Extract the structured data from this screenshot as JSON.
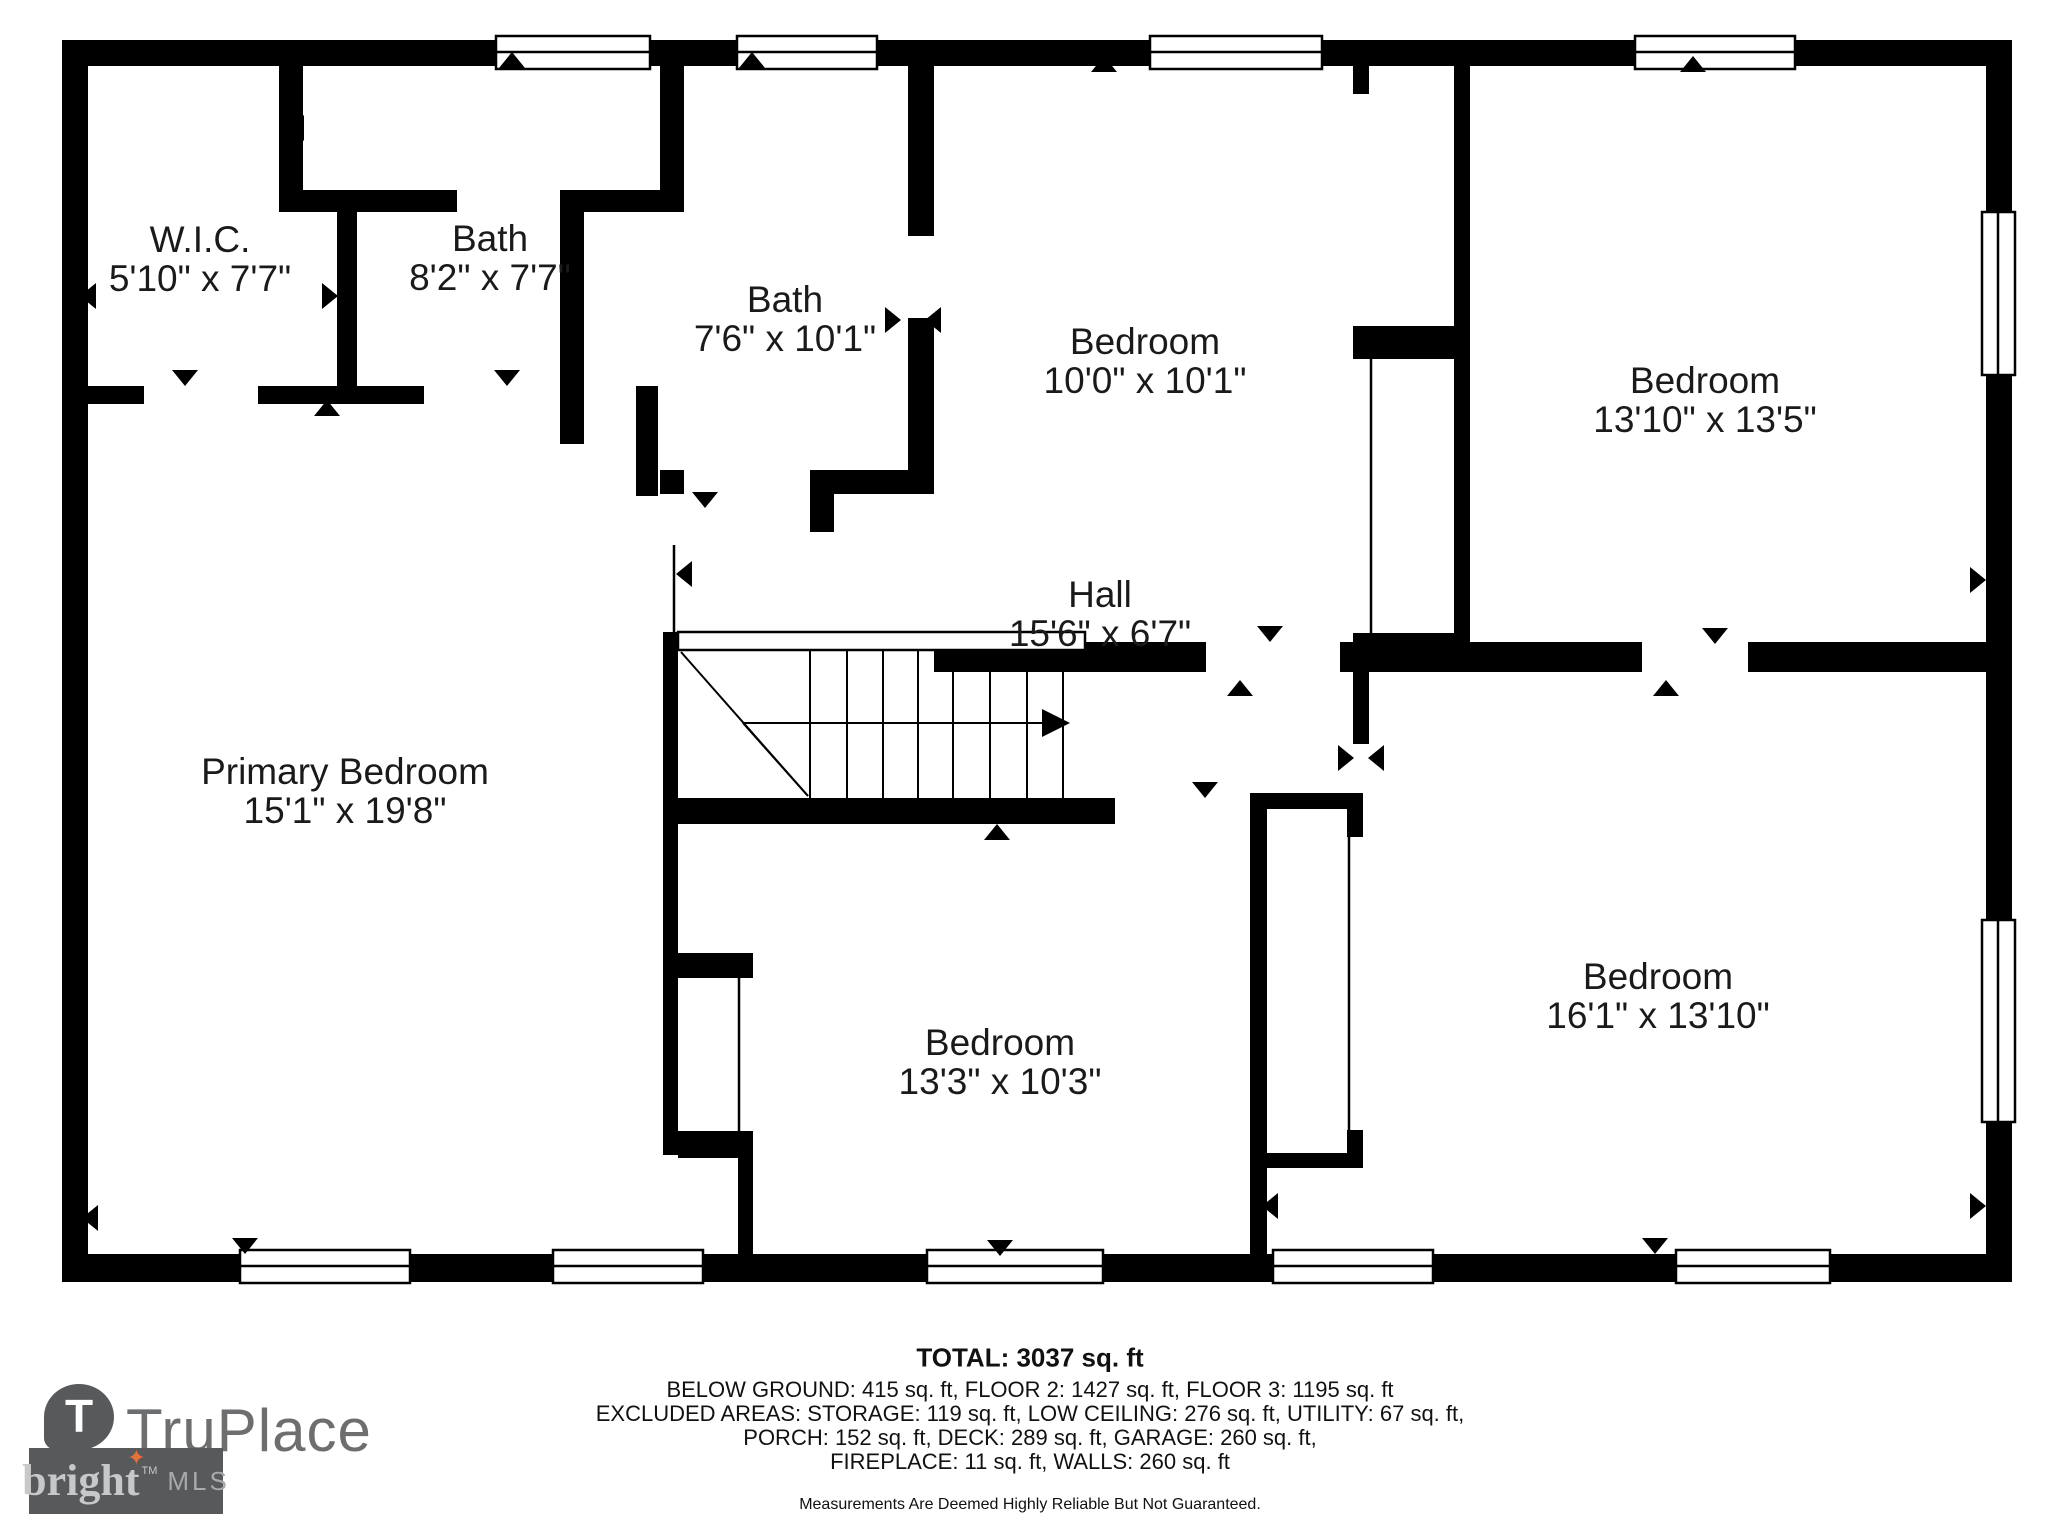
{
  "rooms": [
    {
      "name": "W.I.C.",
      "dims": "5'10\" x 7'7\""
    },
    {
      "name": "Bath",
      "dims": "8'2\" x 7'7\""
    },
    {
      "name": "Bath",
      "dims": "7'6\" x 10'1\""
    },
    {
      "name": "Bedroom",
      "dims": "10'0\" x 10'1\""
    },
    {
      "name": "Bedroom",
      "dims": "13'10\" x 13'5\""
    },
    {
      "name": "Hall",
      "dims": "15'6\" x 6'7\""
    },
    {
      "name": "Primary Bedroom",
      "dims": "15'1\" x 19'8\""
    },
    {
      "name": "Bedroom",
      "dims": "13'3\" x 10'3\""
    },
    {
      "name": "Bedroom",
      "dims": "16'1\" x 13'10\""
    }
  ],
  "footer": {
    "total": "TOTAL: 3037 sq. ft",
    "line1": "BELOW GROUND: 415 sq. ft, FLOOR 2: 1427 sq. ft, FLOOR 3: 1195 sq. ft",
    "line2": "EXCLUDED AREAS: STORAGE: 119 sq. ft, LOW CEILING: 276 sq. ft, UTILITY: 67 sq. ft,",
    "line3": "PORCH: 152 sq. ft, DECK: 289 sq. ft, GARAGE: 260 sq. ft,",
    "line4": "FIREPLACE: 11 sq. ft, WALLS: 260 sq. ft",
    "disclaimer": "Measurements Are Deemed Highly Reliable But Not Guaranteed."
  },
  "branding": {
    "truplace_monogram": "T",
    "truplace_name": "TruPlace",
    "bright_name": "bright",
    "bright_star": "✦",
    "bright_tm": "TM",
    "bright_mls": "MLS",
    "colors": {
      "wall_black": "#000000",
      "logo_badge_gray": "#58595b",
      "logo_text_gray": "#6d6e70",
      "bright_bg": "#58595a",
      "bright_star_orange": "#e8713a"
    }
  }
}
